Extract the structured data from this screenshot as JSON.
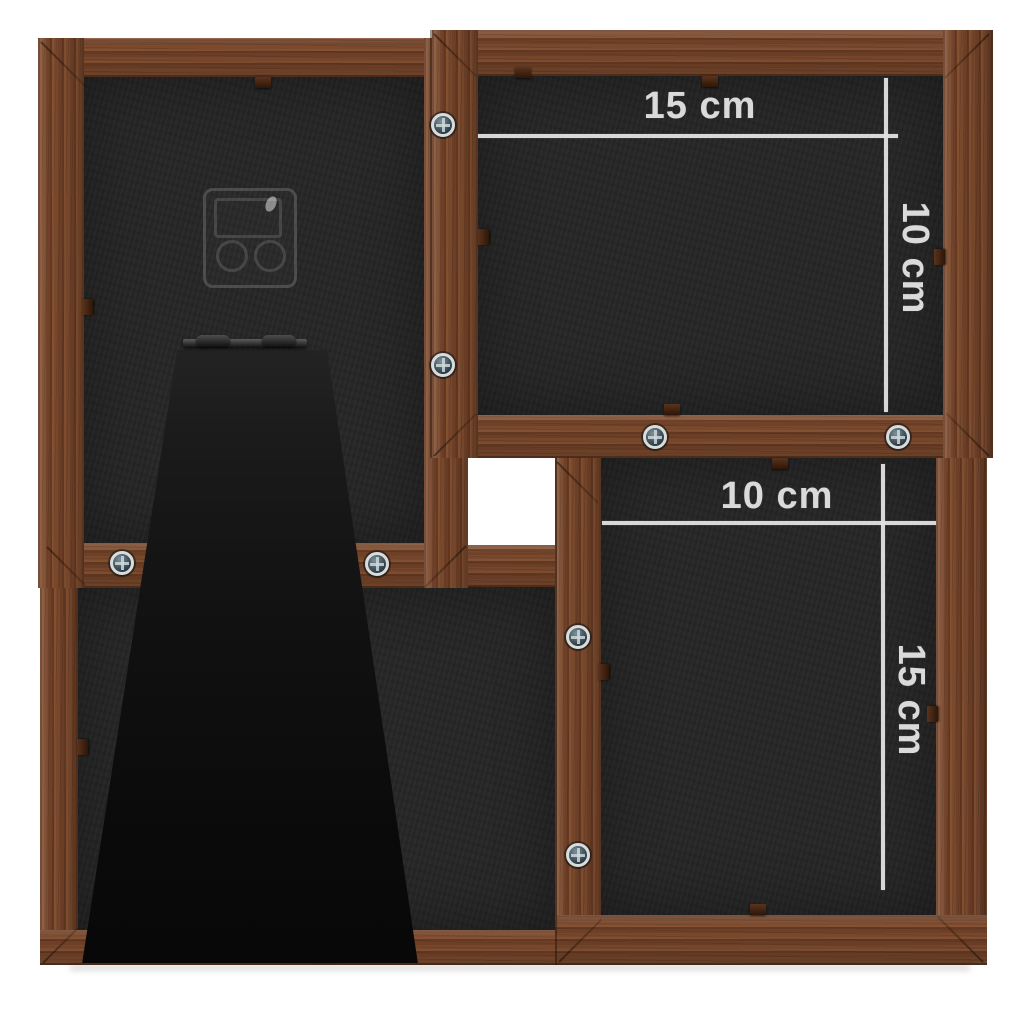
{
  "scene": {
    "description": "Back view of a dark brown wooden 4-photo collage frame with fold-out easel stand, clear wall hanger and photo size annotations",
    "background_color": "#ffffff"
  },
  "palette": {
    "wood": "#7b4a2e",
    "wood_shadow": "#59301a",
    "backing": "#272727",
    "stand": "#111111",
    "annotation_line": "#e2e2e2",
    "annotation_text": "#dadada",
    "screw_metal": "#cfd6d8"
  },
  "annotations": {
    "top_right": {
      "width": "15 cm",
      "height": "10 cm"
    },
    "bottom_right": {
      "width": "10 cm",
      "height": "15 cm"
    }
  },
  "hardware": {
    "screws": 8,
    "retainer_clips": 12,
    "hanger": "clear-plastic-wall-hanger",
    "stand": "fold-out-easel-stand",
    "hinge": "metal-stand-hinge"
  }
}
